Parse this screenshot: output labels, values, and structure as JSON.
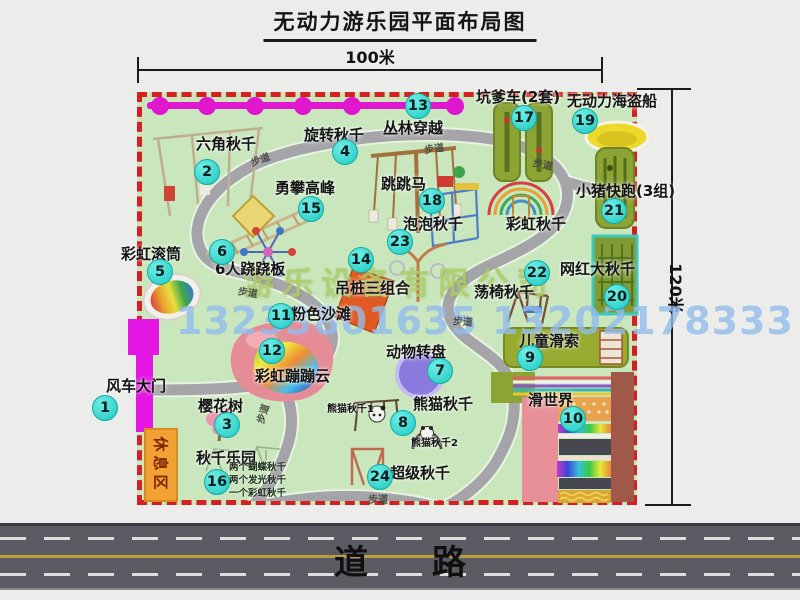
{
  "title": "无动力游乐园平面布局图",
  "dim_width": "100米",
  "dim_height": "120米",
  "road_label": "道 路",
  "walkway": "步道",
  "rest_area": "休息区",
  "watermark_company": "游乐设备有限公司",
  "watermark_phone": "13233801635 13202178333",
  "unnumbered": {
    "rainbow_swing": "彩虹秋千",
    "panda_swing_1": "熊猫秋千1",
    "panda_swing_2": "熊猫秋千2"
  },
  "swing_park_notes": [
    "两个蝴蝶秋千",
    "两个发光秋千",
    "一个彩虹秋千"
  ],
  "items": [
    {
      "num": "1",
      "label": "风车大门"
    },
    {
      "num": "2",
      "label": "六角秋千"
    },
    {
      "num": "3",
      "label": "樱花树"
    },
    {
      "num": "4",
      "label": "旋转秋千"
    },
    {
      "num": "5",
      "label": "彩虹滚筒"
    },
    {
      "num": "6",
      "label": "6人跷跷板"
    },
    {
      "num": "7",
      "label": "动物转盘"
    },
    {
      "num": "8",
      "label": "熊猫秋千"
    },
    {
      "num": "9",
      "label": "儿童滑索"
    },
    {
      "num": "10",
      "label": "滑世界"
    },
    {
      "num": "11",
      "label": "粉色沙滩"
    },
    {
      "num": "12",
      "label": "彩虹蹦蹦云"
    },
    {
      "num": "13",
      "label": "丛林穿越"
    },
    {
      "num": "14",
      "label": "吊桩三组合"
    },
    {
      "num": "15",
      "label": "勇攀高峰"
    },
    {
      "num": "16",
      "label": "秋千乐园"
    },
    {
      "num": "17",
      "label": "坑爹车(2套)"
    },
    {
      "num": "18",
      "label": "跳跳马"
    },
    {
      "num": "19",
      "label": "无动力海盗船"
    },
    {
      "num": "20",
      "label": "网红大秋千"
    },
    {
      "num": "21",
      "label": "小猪快跑(3组)"
    },
    {
      "num": "22",
      "label": "荡椅秋千"
    },
    {
      "num": "23",
      "label": "泡泡秋千"
    },
    {
      "num": "24",
      "label": "超级秋千"
    }
  ],
  "colors": {
    "park_fill": "#c9e6bd",
    "border_red": "#d32020",
    "badge_teal": "#1cc9c2",
    "zipline_magenta": "#df17cf",
    "gate_magenta": "#e316e3",
    "rest_area_orange": "#f2a233",
    "road_gray": "#5b5b63"
  }
}
